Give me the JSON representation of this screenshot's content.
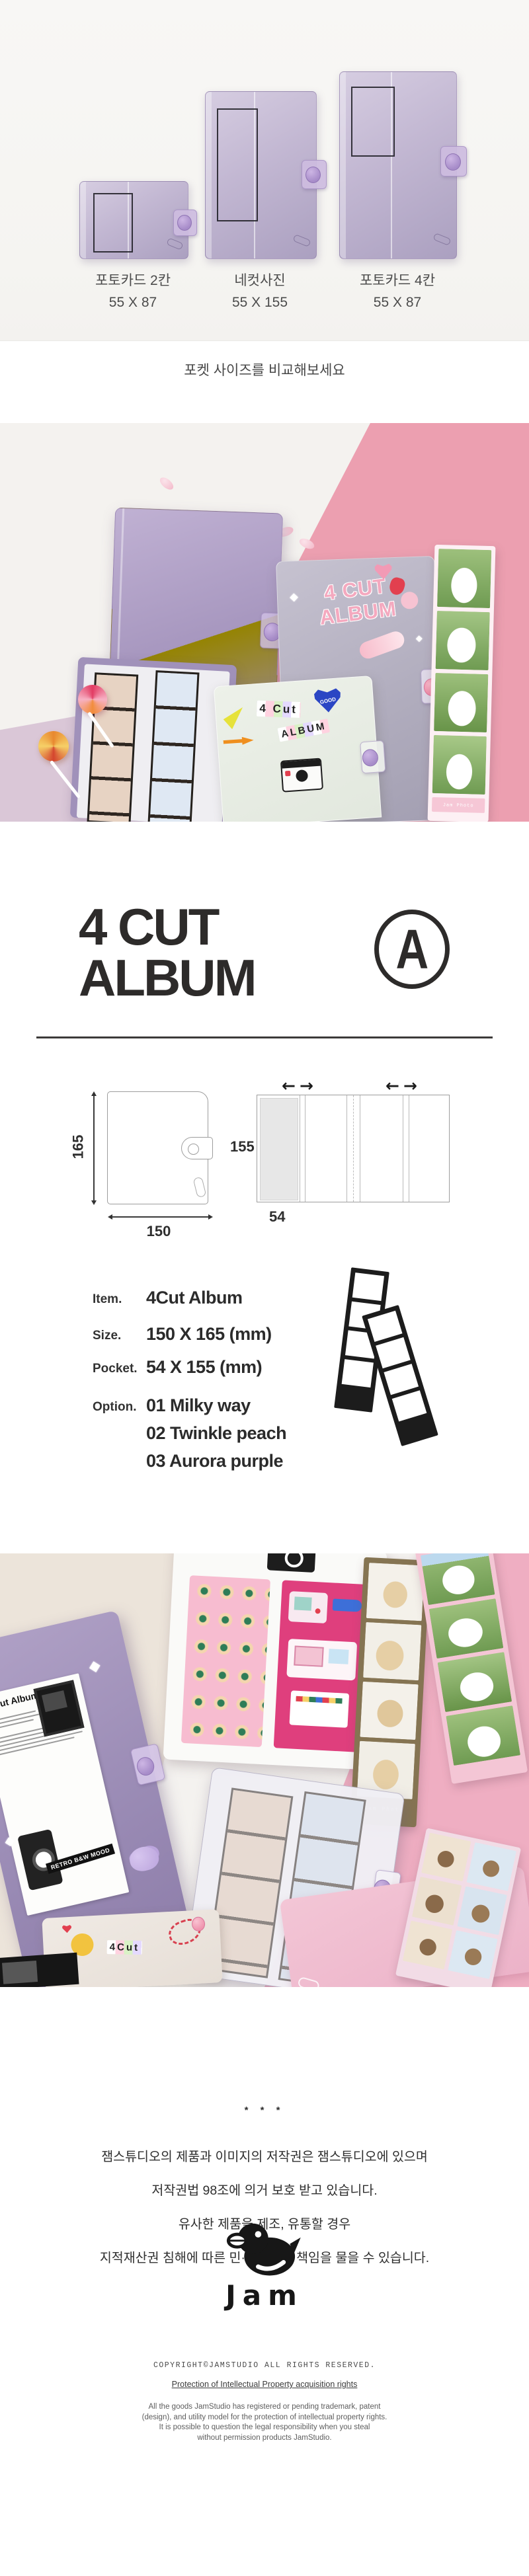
{
  "compare": {
    "caption": "포켓 사이즈를 비교해보세요",
    "items": [
      {
        "label": "포토카드 2칸",
        "size": "55 X 87"
      },
      {
        "label": "네컷사진",
        "size": "55 X 155"
      },
      {
        "label": "포토카드 4칸",
        "size": "55 X 87"
      }
    ]
  },
  "title": {
    "line1": "4 CUT",
    "line2": "ALBUM",
    "badge": "A"
  },
  "diagram": {
    "front": {
      "height_label": "165",
      "width_label": "150"
    },
    "open": {
      "height_label": "155",
      "pocket_width_label": "54"
    }
  },
  "icons": {
    "arrow_left": "←",
    "arrow_right": "→"
  },
  "specs": {
    "item_label": "Item.",
    "item_value": "4Cut Album",
    "size_label": "Size.",
    "size_value": "150 X 165 (mm)",
    "pocket_label": "Pocket.",
    "pocket_value": "54 X 155 (mm)",
    "option_label": "Option.",
    "options": [
      "01 Milky way",
      "02 Twinkle peach",
      "03 Aurora purple"
    ]
  },
  "photo1": {
    "album_sticker_line1": "4 CUT",
    "album_sticker_line2": "ALBUM",
    "collage_line1": "4 Cut",
    "collage_line2": "ALBUM",
    "heart_label": "GOOD",
    "strip_label": "Jam Photo"
  },
  "photo2": {
    "album_title": "4 Cut Album",
    "retro_label": "RETRO B&W MOOD",
    "strip_label": "Jam Photo",
    "collage": "4Cut"
  },
  "notice": {
    "stars": "* * *",
    "lines": [
      "잼스튜디오의 제품과 이미지의 저작권은 잼스튜디오에 있으며",
      "저작권법 98조에 의거 보호 받고 있습니다.",
      "유사한 제품을 제조, 유통할 경우",
      "지적재산권 침해에 따른 민·형사상의 책임을 물을 수 있습니다."
    ]
  },
  "footer": {
    "logo_text": "Jam",
    "copyright": "COPYRIGHT©JAMSTUDIO ALL RIGHTS RESERVED.",
    "ip_link": "Protection of Intellectual Property acquisition rights",
    "lines": [
      "All the goods JamStudio has registered or pending trademark, patent",
      "(design), and utility model for the protection of intellectual property rights.",
      "It is possible to question the legal responsibility when you steal",
      "without permission products JamStudio."
    ]
  }
}
